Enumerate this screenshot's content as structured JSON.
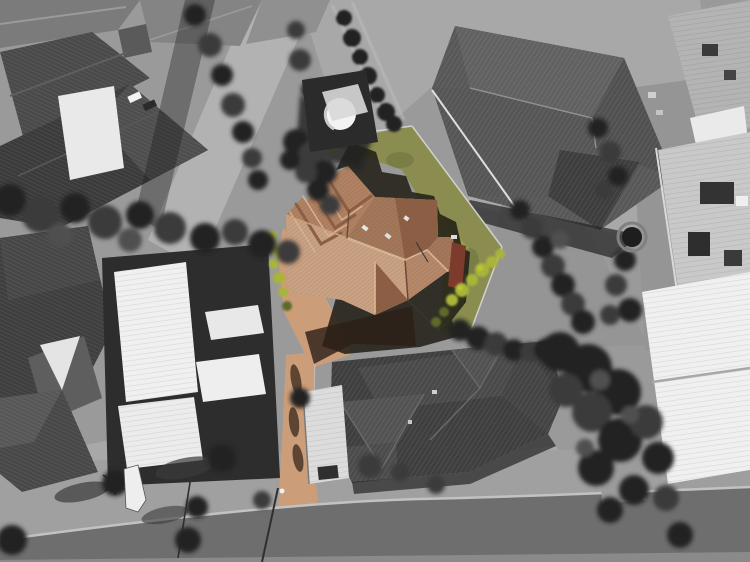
{
  "meta": {
    "image_type": "aerial drone photograph",
    "style": "selective color real-estate photo: subject property in color, surroundings desaturated grayscale",
    "subject": "terracotta hip-and-gable roof house on pentagonal lot with olive lawn and salmon driveway leading to street at bottom",
    "surroundings": "grayscale suburban houses: dark gabled roofs top-left, large gray roof top-right, white flat roofs left and right, charcoal hip-roof house bottom-center, dense trees bottom-right, asphalt road along bottom edge"
  },
  "palette": {
    "bg": "#9a9a9a",
    "road": "#6e6e6e",
    "road_far": "#8a8a8a",
    "curb": "#c2c2c2",
    "verge": "#a0a0a0",
    "lane": "#b2b2b2",
    "concrete": "#a8a8a8",
    "concrete_light": "#b6b6b6",
    "roof_charcoal": "#3f3f3f",
    "roof_charcoal2": "#4a4a4a",
    "roof_dark": "#333333",
    "roof_gray": "#585858",
    "roof_gray2": "#616161",
    "roof_gray3": "#7b7b7b",
    "ridge_light": "#9a9a9a",
    "white_roof": "#f0f0f0",
    "white_dim": "#dcdcdc",
    "ribbed_light": "#c9c9c9",
    "tree_dark": "#232323",
    "tree_mid": "#3a3a3a",
    "tree_light": "#4f4f4f",
    "shadow": "#1e1c14",
    "shadow_cool": "#262626",
    "grass_olive": "#8a8d4f",
    "grass_light": "#9aa355",
    "grass_dark": "#6e7240",
    "gray_grass": "#959595",
    "bush_green": "#a9b43b",
    "bush_bright": "#bcc832",
    "bush_dark": "#5f6b2a",
    "roof_terra": "#b08163",
    "roof_terra_light": "#c9a183",
    "roof_terra_mid": "#a2775a",
    "roof_terra_dark": "#8d6046",
    "roof_terra_s": "#b5886a",
    "ridge_terra": "#d8b794",
    "valley_terra": "#6e4a36",
    "drive_salmon": "#cc9d79",
    "shadow_warm": "#2c1f16",
    "red_structure": "#7c3b2b",
    "tank_white": "#f3f3f3",
    "fence_light": "#d8d8d8",
    "rib_light": "rgba(255,255,255,0.13)",
    "rib_dark": "rgba(0,0,0,0.10)",
    "tile_line": "rgba(70,35,15,0.25)",
    "pole": "#2f2f2f",
    "car_white": "#f2f2f2",
    "car_dark": "#2b2b2b"
  }
}
